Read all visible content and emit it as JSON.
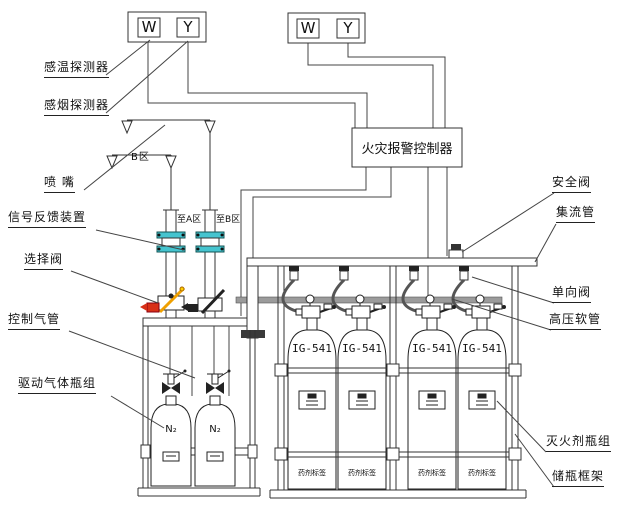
{
  "diagram": {
    "controller": {
      "title": "火灾报警控制器"
    },
    "labels": {
      "temp_detector": "感温探测器",
      "smoke_detector": "感烟探测器",
      "nozzle": "喷 嘴",
      "signal_feedback": "信号反馈装置",
      "selector_valve": "选择阀",
      "control_pipe": "控制气管",
      "driving_gas_group": "驱动气体瓶组",
      "safety_valve": "安全阀",
      "collecting_pipe": "集流管",
      "check_valve": "单向阀",
      "hp_hose": "高压软管",
      "agent_cylinder_group": "灭火剂瓶组",
      "cylinder_frame": "储瓶框架",
      "zone_b": "B区",
      "to_zone_a": "至A区",
      "to_zone_b": "至B区"
    },
    "symbols": {
      "temp": "W",
      "smoke": "Y"
    },
    "equipment": {
      "agent_model": "IG-541",
      "agent_tag": "药剂标签",
      "driving_gas": "N₂",
      "agent_cylinder_count": 4,
      "driving_cylinder_count": 2
    },
    "colors": {
      "line": "#333333",
      "flange_teal": "#45c4cf",
      "handle_orange": "#f0a000",
      "valve_red": "#d83018",
      "pipe_gray": "#9b9b9b"
    }
  }
}
